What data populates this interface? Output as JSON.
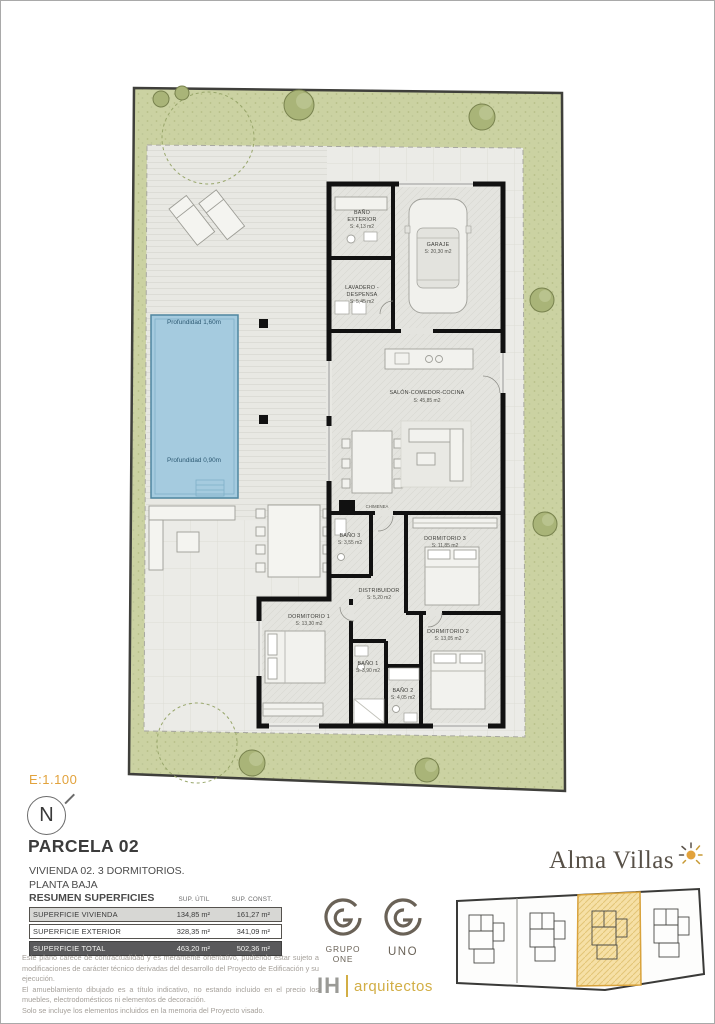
{
  "page": {
    "scale_label": "E:1.100",
    "north_label": "N",
    "title": "PARCELA 02",
    "subtitle_line1": "VIVIENDA 02. 3 DORMITORIOS.",
    "subtitle_line2": "PLANTA BAJA"
  },
  "plan": {
    "pool": {
      "depth_top": "Profundidad 1,60m",
      "depth_bottom": "Profundidad 0,90m"
    },
    "rooms": [
      {
        "name": "BAÑO",
        "name2": "EXTERIOR",
        "area": "S: 4,13 m2"
      },
      {
        "name": "GARAJE",
        "area": "S: 20,30 m2"
      },
      {
        "name": "LAVADERO -",
        "name2": "DESPENSA",
        "area": "S: 5,45 m2"
      },
      {
        "name": "SALÓN-COMEDOR-COCINA",
        "area": "S: 45,85 m2"
      },
      {
        "name": "CHIMENEA",
        "area": ""
      },
      {
        "name": "BAÑO 3",
        "area": "S: 3,55 m2"
      },
      {
        "name": "DORMITORIO 3",
        "area": "S: 11,85 m2"
      },
      {
        "name": "DISTRIBUIDOR",
        "area": "S: 5,20 m2"
      },
      {
        "name": "DORMITORIO 1",
        "area": "S: 13,30 m2"
      },
      {
        "name": "DORMITORIO 2",
        "area": "S: 13,05 m2"
      },
      {
        "name": "BAÑO 1",
        "area": "S: 3,90 m2"
      },
      {
        "name": "BAÑO 2",
        "area": "S: 4,05 m2"
      }
    ]
  },
  "summary_table": {
    "title": "RESUMEN SUPERFICIES",
    "col1": "SUP. ÚTIL",
    "col2": "SUP. CONST.",
    "rows": [
      {
        "label": "SUPERFICIE VIVIENDA",
        "util": "134,85 m²",
        "const": "161,27 m²"
      },
      {
        "label": "SUPERFICIE EXTERIOR",
        "util": "328,35 m²",
        "const": "341,09 m²"
      },
      {
        "label": "SUPERFICIE TOTAL",
        "util": "463,20 m²",
        "const": "502,36 m²"
      }
    ]
  },
  "disclaimer": {
    "p1": "Este plano carece de contractualidad y es meramente orientativo, pudiendo estar sujeto a modificaciones de carácter técnico derivadas del desarrollo del Proyecto de Edificación y su ejecución.",
    "p2": "El amueblamiento dibujado es a título indicativo, no estando incluido en el precio los muebles, electrodomésticos ni elementos de decoración.",
    "p3": "Solo se incluye los elementos incluidos en la memoria del Proyecto visado."
  },
  "logos": {
    "grupo_one": "GRUPO ONE",
    "uno": "UNO",
    "ih": "IH",
    "ih_sub": "arquitectos",
    "alma_villas": "Alma Villas"
  },
  "colors": {
    "accent_gold": "#e2a23c",
    "pool_blue": "#a5cbdf",
    "garden_green": "#cbd2a2",
    "keyplan_highlight": "#f6e0a6",
    "wall_black": "#111111"
  }
}
